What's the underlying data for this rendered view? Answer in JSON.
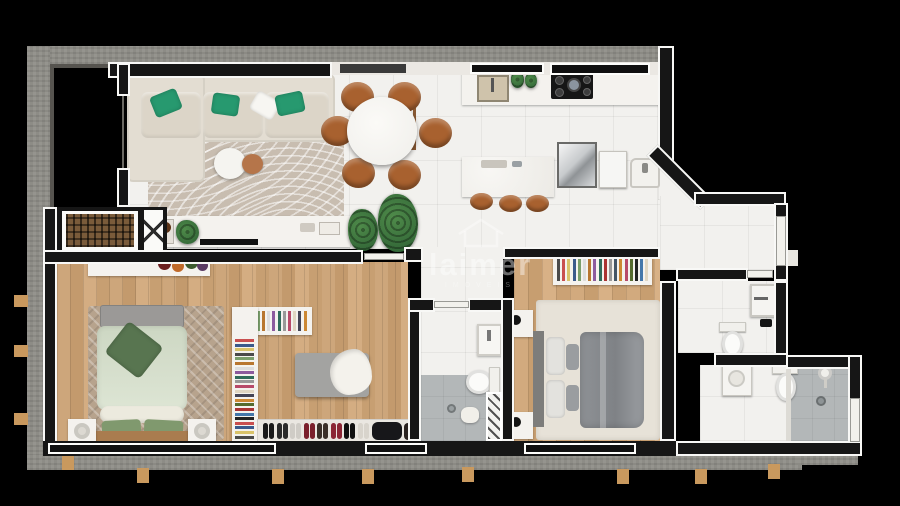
{
  "watermark": {
    "brand": "laimer",
    "tagline": "IMÓVEIS",
    "icon": "house-outline-icon"
  },
  "palette": {
    "bg": "#000000",
    "concrete": "#8d8c86",
    "wall": "#161616",
    "wall-outline": "#f8f8f6",
    "tile": "#f2f1ee",
    "shower": "#b3b7b8",
    "tab": "#c9995e",
    "sofa": "#e3ddd2",
    "pillow-green": "#27996f",
    "rug-living": "#c8bdb0",
    "rug-bed1": "#b7a38d",
    "rug-bed2": "#e7e2d8",
    "chair": "#a8612f",
    "stool": "#a8612f",
    "plant": "#2c5f33",
    "grate": "#7a5b3a",
    "duvet-sage": "#cdd7c3",
    "pillow-sage": "#80996e",
    "headboard-wood": "#a97c4f",
    "duvet-gray": "#8f9296",
    "watermark": "rgba(255,255,255,0.42)"
  },
  "scene": {
    "rooms": [
      "balcony",
      "living-room",
      "dining-area",
      "kitchen",
      "laundry-corner",
      "hallway",
      "suite-bedroom",
      "walk-in-closet",
      "suite-bathroom",
      "second-bedroom",
      "bathroom",
      "shower-bathroom",
      "elevator",
      "shaft"
    ],
    "closet": {
      "clothes_colors": [
        "#c94f4f",
        "#3b5a8c",
        "#d9c36a",
        "#4a4a4a",
        "#7a9e6b",
        "#b8762f",
        "#dddddd",
        "#8c5a9e",
        "#2f6b5a",
        "#999999",
        "#b84a6a",
        "#e0d6c2",
        "#444455",
        "#cc8833",
        "#556b2f",
        "#aa3333",
        "#4477aa",
        "#222222"
      ],
      "shoe_colors": [
        "#1a1a1a",
        "#2b2b2b",
        "#cfccc6",
        "#7a1f2b",
        "#3a2f28",
        "#8b2635",
        "#101010",
        "#d8d4cc"
      ]
    },
    "wardrobe2": {
      "clothes_colors": [
        "#4a4a4a",
        "#c94f4f",
        "#d9c36a",
        "#3b5a8c",
        "#7a9e6b",
        "#dddddd",
        "#b8762f",
        "#8c5a9e",
        "#2f6b5a",
        "#aa3333",
        "#999999",
        "#445566",
        "#cc8833",
        "#b84a6a",
        "#556b2f",
        "#222222",
        "#4477aa",
        "#e0d6c2"
      ]
    },
    "dining": {
      "chair_count": 6
    },
    "kitchen_island": {
      "stool_count": 3
    },
    "bed1_pillows": [
      "#80996e",
      "#80996e"
    ],
    "fruit_bowls": [
      "#6b1f1f",
      "#c06a2a",
      "#3c5a2e",
      "#5a3b63"
    ]
  }
}
